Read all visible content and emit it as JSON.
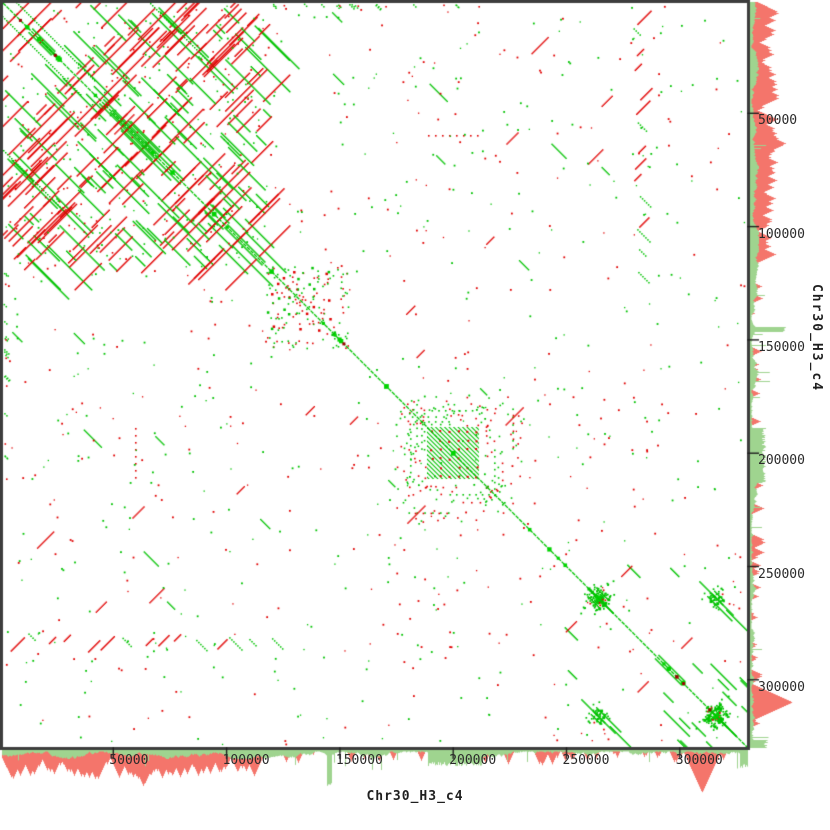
{
  "chart_data": {
    "type": "scatter",
    "plot_kind": "dna-dotplot-self-alignment",
    "x_sequence": "Chr30_H3_c4",
    "y_sequence": "Chr30_H3_c4",
    "sequence_length_bp": 329500,
    "px_per_bp": 0.002266,
    "axes": {
      "x_side": "bottom",
      "y_side": "right",
      "tick_bp": [
        50000,
        100000,
        150000,
        200000,
        250000,
        300000
      ],
      "tick_labels": [
        "50000",
        "100000",
        "150000",
        "200000",
        "250000",
        "300000"
      ],
      "grid": false
    },
    "colors": {
      "forward_match": "#00c300",
      "reverse_match": "#e10000",
      "diagonal": "#00c300",
      "diagonal_accent": "#00d400",
      "diagonal_dark": "#9b0000",
      "histogram_forward": "#9fd48f",
      "histogram_reverse": "#f4756b",
      "border": "#3d3d3d",
      "tick": "#1e1e1e",
      "label": "#2b2b2b",
      "background": "#ffffff"
    },
    "layout": {
      "plot_left": 2,
      "plot_top": 2,
      "plot_size": 746,
      "border_px": 3,
      "hist_baseline": 750,
      "tick_len": 9,
      "x_label_top": 754,
      "y_label_left": 758
    },
    "seed": 1337,
    "features": {
      "main_diagonal": {
        "accent_green": 26,
        "accent_dark": 7
      },
      "repeat_block": {
        "bp": [
          0,
          117000
        ],
        "x0": 4,
        "y0": 4,
        "x1": 266,
        "y1": 266,
        "segments": 160,
        "forward_ratio": 0.42,
        "len_min": 7,
        "len_max": 50,
        "extra_dots": 110
      },
      "corner_offsets": [
        [
          2,
          16,
          80
        ],
        [
          150,
          3,
          60
        ]
      ],
      "top_edge_band": {
        "x0": 270,
        "x1": 500,
        "green": 14,
        "red": 6
      },
      "mid_cluster": {
        "bp": [
          117000,
          153000
        ],
        "x0": 266,
        "y0": 266,
        "x1": 348,
        "y1": 348,
        "dots": 85,
        "forward_ratio": 0.5
      },
      "satellite_block": {
        "bp": [
          188400,
          211400
        ],
        "x0": 427,
        "y0": 427,
        "x1": 479,
        "y1": 479,
        "hatch_spacing": 4.5,
        "red_grid_step": 9
      },
      "satellite_ring": {
        "x0": 396,
        "y0": 396,
        "x1": 524,
        "y1": 524,
        "dots": 95,
        "columns": 7
      },
      "band_637": {
        "bp": 281000,
        "pos": 637,
        "s0": 5,
        "s1": 285,
        "segments": 15
      },
      "dotted_column": {
        "x": 135,
        "y0": 428,
        "y1": 482,
        "step": 7
      },
      "clusters_on_diag": [
        {
          "bp": 263900,
          "c": 598,
          "n": 55,
          "sigma": 15
        },
        {
          "bp": 316000,
          "c": 716,
          "n": 60,
          "sigma": 15
        }
      ],
      "clusters_off_diag": [
        {
          "cx": 598,
          "cy": 716,
          "n": 42,
          "sigma": 14
        }
      ],
      "lr_segments": {
        "x0": 560,
        "x1": 742,
        "n": 14,
        "len_min": 8,
        "len_max": 26
      },
      "scatter_segments": {
        "n": 20,
        "len_min": 6,
        "len_max": 18
      },
      "sparse_dots": {
        "n": 430,
        "forward_ratio": 0.53
      }
    },
    "histogram": {
      "bins": 746,
      "green_base_min": 1.5,
      "green_base_max": 9,
      "green_spike_p": 0.015,
      "green_spike_max": 20,
      "red_dense_range": [
        0,
        253
      ],
      "red_dense_p": 0.62,
      "red_dense_max": 26,
      "red_sparse_p": 0.1,
      "red_sparse_max": 13,
      "green_features": [
        {
          "r": [
            325,
            330
          ],
          "v": 34
        },
        {
          "r": [
            426,
            481
          ],
          "v": 14
        },
        {
          "r": [
            738,
            746
          ],
          "v": 16
        }
      ],
      "red_features": [
        {
          "r": [
            140,
            144
          ],
          "v": 34
        },
        {
          "r": [
            699,
            702
          ],
          "v": 42
        }
      ]
    }
  }
}
